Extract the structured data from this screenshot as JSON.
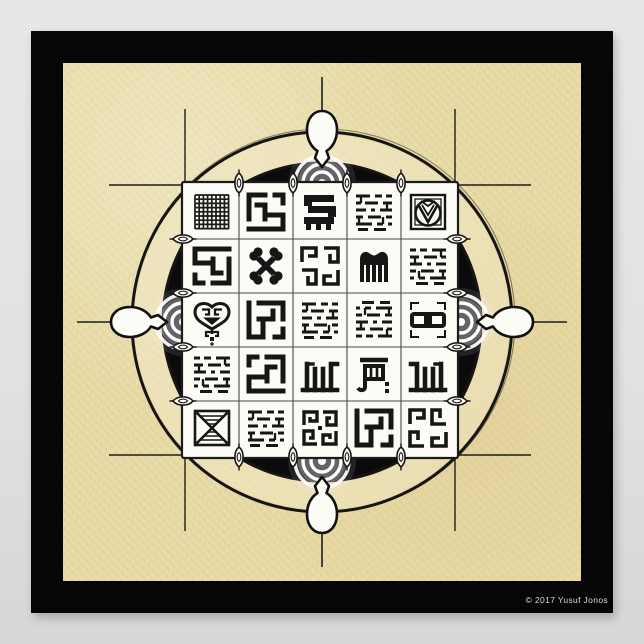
{
  "poster": {
    "copyright": "© 2017 Yusuf Jonos",
    "colors": {
      "wall": "#e2e2e2",
      "frame": "#060606",
      "parchment": "#e9dba6",
      "ink": "#161616",
      "disc": "#0b0b0b",
      "tile": "#fcfbf6",
      "glow": "#ffffff"
    }
  },
  "mandala": {
    "grid": {
      "rows": 5,
      "cols": 5
    },
    "symbols": [
      [
        "crosshatch-grid",
        "kufic-calligraphy-block",
        "bold-bar-maze-glyph",
        "kufic-micro-script-block",
        "circle-v-rosette"
      ],
      [
        "kufic-maze-square",
        "crossed-bones",
        "kufic-hook-cluster",
        "duafe-comb",
        "kufic-script-block"
      ],
      [
        "sankofa-heart",
        "kufic-square-spiral",
        "kufic-script-lines",
        "kufic-micro-script-block",
        "interlocked-chain-links"
      ],
      [
        "kufic-script-block",
        "kufic-square-spiral-mirrored",
        "kufic-vertical-strokes",
        "bar-and-hook-glyph",
        "kufic-vertical-strokes-mirrored"
      ],
      [
        "hatched-x-square",
        "kufic-micro-script-block",
        "meander-spirals",
        "kufic-square-spiral-rotated",
        "kufic-hook-cluster-rotated"
      ]
    ],
    "ornaments": {
      "compass_pointers": [
        "north",
        "east",
        "south",
        "west"
      ],
      "bullseye_glows": [
        "north",
        "east",
        "south",
        "west"
      ],
      "edge_leaves_per_side": 4
    }
  }
}
